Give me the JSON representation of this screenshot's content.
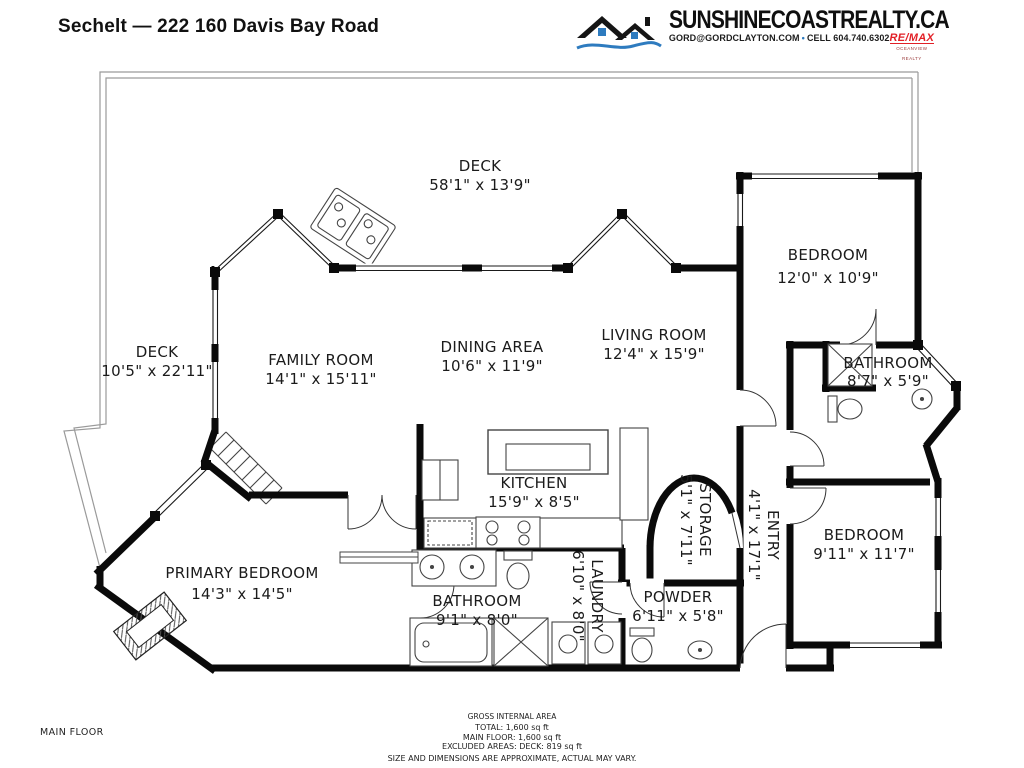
{
  "header": {
    "title": "Sechelt — 222 160 Davis Bay Road",
    "brand": {
      "site": "SUNSHINECOASTREALTY.CA",
      "contact_email": "GORD@GORDCLAYTON.COM",
      "separator": "•",
      "contact_phone": "CELL 604.740.6302",
      "remax": "RE/MAX",
      "remax_sub": "OCEANVIEW REALTY"
    }
  },
  "floor_label": "MAIN FLOOR",
  "rooms": [
    {
      "name": "DECK",
      "dims": "58'1\" x 13'9\""
    },
    {
      "name": "DECK",
      "dims": "10'5\" x 22'11\""
    },
    {
      "name": "FAMILY ROOM",
      "dims": "14'1\" x 15'11\""
    },
    {
      "name": "DINING AREA",
      "dims": "10'6\" x 11'9\""
    },
    {
      "name": "LIVING ROOM",
      "dims": "12'4\" x 15'9\""
    },
    {
      "name": "BEDROOM",
      "dims": "12'0\" x 10'9\""
    },
    {
      "name": "BATHROOM",
      "dims": "8'7\" x 5'9\""
    },
    {
      "name": "KITCHEN",
      "dims": "15'9\" x 8'5\""
    },
    {
      "name": "STORAGE",
      "dims": "5'1\" x 7'11\""
    },
    {
      "name": "ENTRY",
      "dims": "4'1\" x 17'1\""
    },
    {
      "name": "BEDROOM",
      "dims": "9'11\" x 11'7\""
    },
    {
      "name": "PRIMARY BEDROOM",
      "dims": "14'3\" x 14'5\""
    },
    {
      "name": "BATHROOM",
      "dims": "9'1\" x 8'0\""
    },
    {
      "name": "LAUNDRY",
      "dims": "6'10\" x 8'0\""
    },
    {
      "name": "POWDER",
      "dims": "6'11\" x 5'8\""
    }
  ],
  "footer": {
    "line1": "GROSS INTERNAL AREA",
    "line2": "TOTAL: 1,600 sq ft",
    "line3": "MAIN FLOOR: 1,600 sq ft",
    "line4": "EXCLUDED AREAS: DECK: 819 sq ft",
    "line5": "SIZE AND DIMENSIONS ARE APPROXIMATE, ACTUAL MAY VARY."
  },
  "colors": {
    "accent_blue": "#2e7bbf",
    "remax_red": "#e21f26",
    "wall": "#0a0a0a"
  }
}
